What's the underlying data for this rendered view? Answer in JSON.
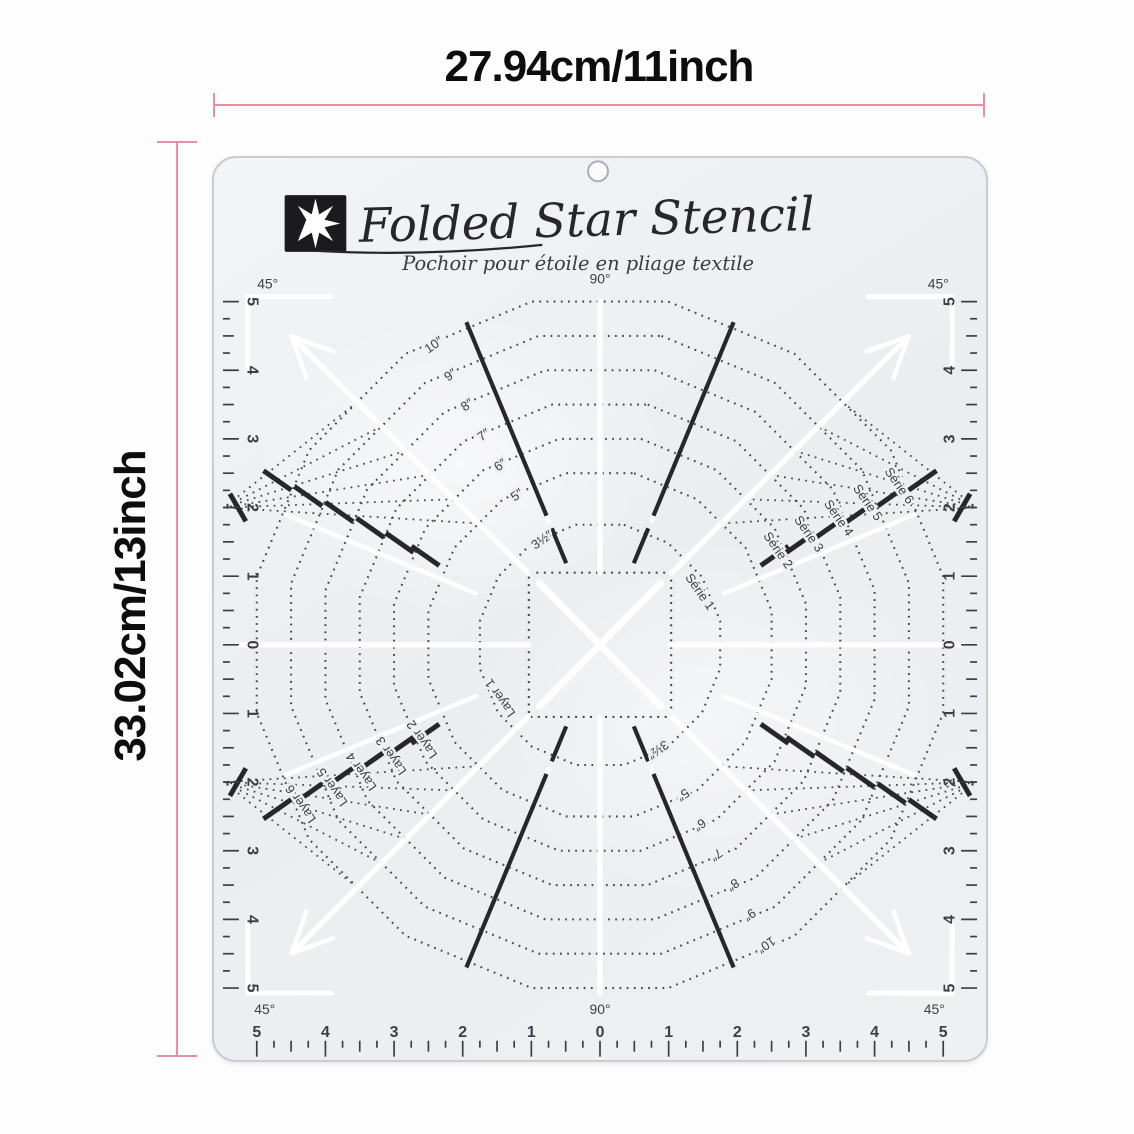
{
  "dimensions": {
    "width_label": "27.94cm/11inch",
    "height_label": "33.02cm/13inch"
  },
  "stencil": {
    "title": "Folded Star Stencil",
    "subtitle": "Pochoir pour étoile en pliage textile",
    "angle_labels": {
      "top_left": "45°",
      "top_center": "90°",
      "top_right": "45°",
      "bottom_left": "45°",
      "bottom_center": "90°",
      "bottom_right": "45°"
    },
    "rulers": {
      "numbers": [
        "5",
        "4",
        "3",
        "2",
        "1",
        "0",
        "1",
        "2",
        "3",
        "4",
        "5"
      ]
    },
    "rings": {
      "diameters_inch": [
        3.5,
        5,
        6,
        7,
        8,
        9,
        10
      ],
      "size_labels": [
        "3½″",
        "5″",
        "6″",
        "7″",
        "8″",
        "9″",
        "10″"
      ]
    },
    "series_labels": [
      "Série 1",
      "Série 2",
      "Série 3",
      "Série 4",
      "Série 5",
      "Série 6"
    ],
    "layer_labels": [
      "Layer 1",
      "Layer 2",
      "Layer 3",
      "Layer 4",
      "Layer 5",
      "Layer 6"
    ],
    "icons": {
      "logo": "eight-point-star-icon"
    },
    "colors": {
      "ink": "#3d3d45",
      "dotted": "#4a4a52",
      "bold": "#26262c",
      "plate": "#eff0f2",
      "accent_pink": "#e98da1",
      "white": "#ffffff"
    }
  }
}
